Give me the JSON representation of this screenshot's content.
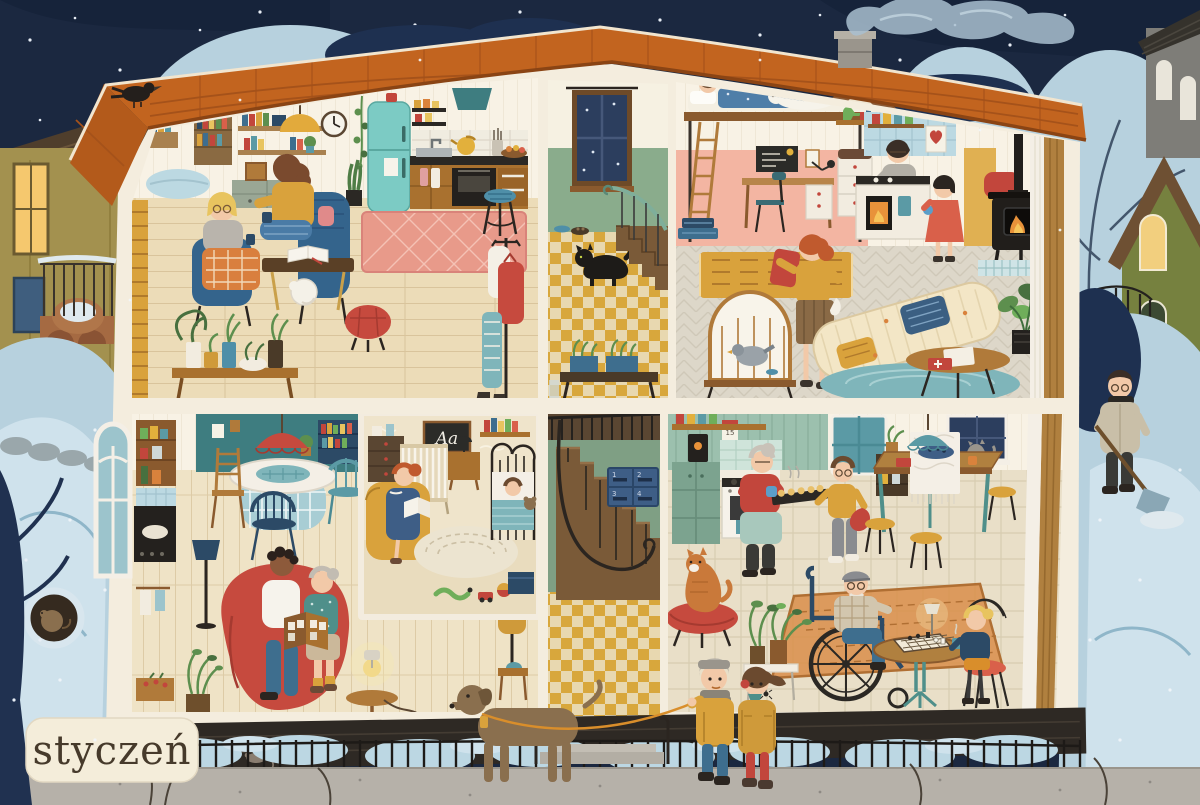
{
  "scene": {
    "month_label": "styczeń",
    "nursery_chalkboard_text": "Aa",
    "kitchen_calendar_day": "15",
    "mailbox_numbers": [
      "1",
      "2",
      "3",
      "4"
    ]
  },
  "palette": {
    "sky": "#1b2840",
    "roof": "#c2641f",
    "roof_shadow": "#a5521a",
    "house_wall": "#f4edde",
    "snow_light": "#cfe2ec",
    "snow_mid": "#b7d1de",
    "stairwell_wall_green": "#8aac8c",
    "tile_mustard": "#d8a73c",
    "accent_red": "#c2463c",
    "accent_teal": "#5b9aa5",
    "accent_mustard": "#d9a23c",
    "fridge_teal": "#7ccbc4",
    "label_bg": "#f4edda",
    "label_text": "#463a2b",
    "night_tree": "#1e3050",
    "sidewalk": "#b6b1a9"
  }
}
